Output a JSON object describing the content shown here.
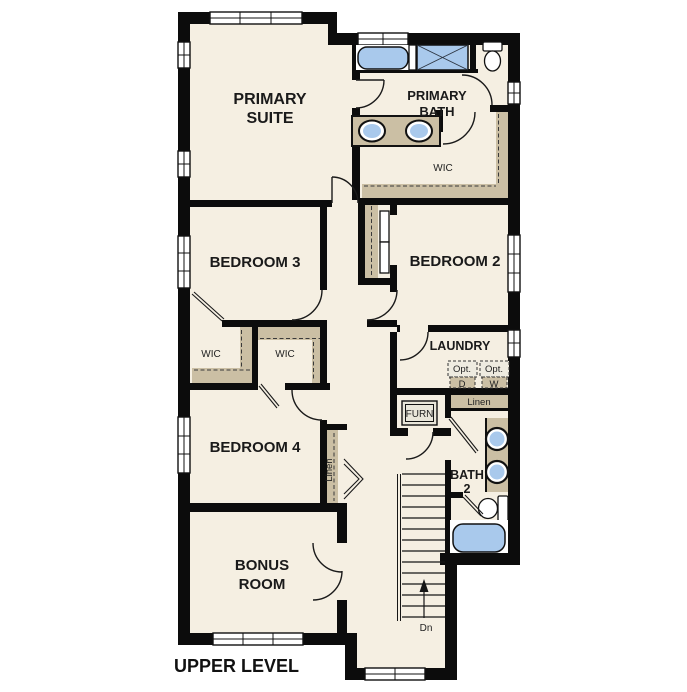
{
  "title": "UPPER LEVEL",
  "colors": {
    "background": "#ffffff",
    "floor": "#f5efe2",
    "wall": "#0c0c0c",
    "shelf_tan": "#cbbfa4",
    "fixture_blue": "#a9c9ec",
    "window_white": "#ffffff"
  },
  "rooms": {
    "primary_suite": {
      "line1": "PRIMARY",
      "line2": "SUITE"
    },
    "primary_bath": {
      "line1": "PRIMARY",
      "line2": "BATH"
    },
    "primary_wic": {
      "label": "WIC"
    },
    "bedroom3": {
      "label": "BEDROOM 3"
    },
    "bedroom2": {
      "label": "BEDROOM 2"
    },
    "wic_bedroom3": {
      "label": "WIC"
    },
    "wic_bedroom4": {
      "label": "WIC"
    },
    "laundry": {
      "label": "LAUNDRY"
    },
    "bedroom4": {
      "label": "BEDROOM 4"
    },
    "bath2": {
      "line1": "BATH",
      "line2": "2"
    },
    "bonus_room": {
      "line1": "BONUS",
      "line2": "ROOM"
    }
  },
  "fixtures": {
    "furnace_label": "FURN",
    "linen_hall_label": "Linen",
    "linen_bedroom4_label": "Linen",
    "optional_dryer": {
      "line1": "Opt.",
      "line2": "D"
    },
    "optional_washer": {
      "line1": "Opt.",
      "line2": "W"
    },
    "stairs_direction": "Dn"
  }
}
